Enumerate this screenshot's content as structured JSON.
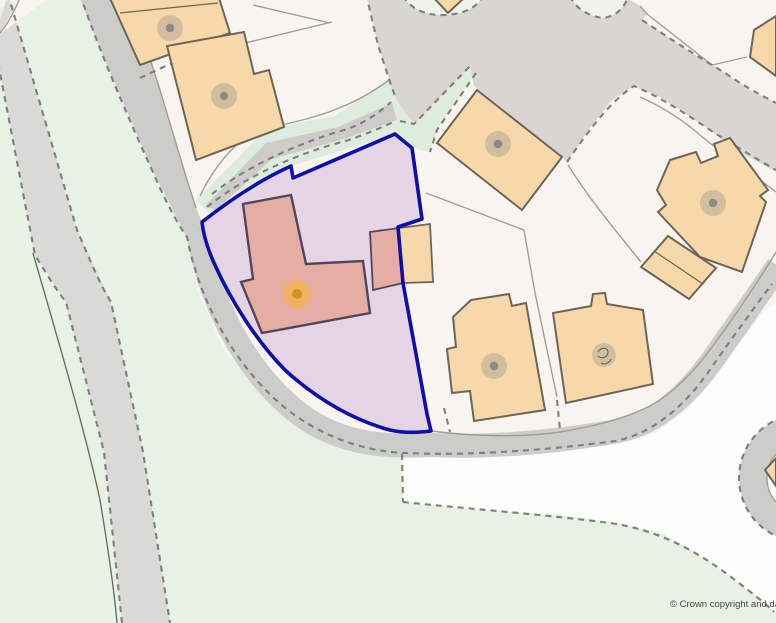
{
  "map": {
    "copyright_text": "© Crown copyright and dat",
    "description": "title-plan map with selected property boundary"
  },
  "icons": {
    "selected_property_marker": "orange-dot-icon",
    "building_marker": "gray-dot-icon",
    "special_building_marker": "gray-symbol-dot-icon"
  },
  "colors": {
    "background": "#f8f5f1",
    "green_area": "#e8f1e4",
    "green_verge": "#ddecdd",
    "green_pocket": "#eef4ec",
    "road_minor": "#d9d9d6",
    "road_junction": "#d9d6d2",
    "road_major": "#ccccc8",
    "path_strip": "#cdccc9",
    "white_area": "#fdfdfc",
    "dash_line": "#7f7f7c",
    "plot_line": "#a39d94",
    "fence_line": "#66665f",
    "building_fill": "#f7d8a9",
    "building_stroke": "#6e645a",
    "boundary_stroke": "#0f0fa8",
    "boundary_fill": "#e4d4e6",
    "selected_building_fill": "#e5aea4",
    "selected_building_stroke": "#53445c",
    "marker_orange_halo": "rgba(242,179,86,0.85)",
    "marker_orange_core": "#cf9320",
    "dot_halo": "rgba(140,140,138,0.35)",
    "dot_core": "#8a8a86",
    "copyright_color": "#454545"
  }
}
